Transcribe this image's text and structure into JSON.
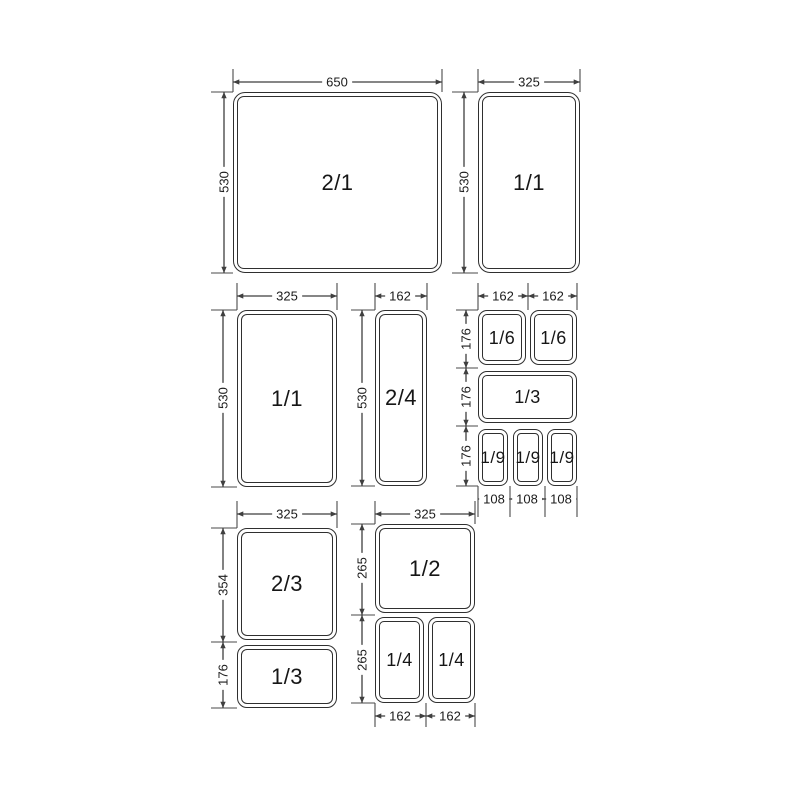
{
  "colors": {
    "background": "#ffffff",
    "line": "#3f3f3f",
    "box_border": "#2f2f2f",
    "text": "#1c1c1c"
  },
  "pans": {
    "gn_2_1": {
      "label": "2/1"
    },
    "gn_1_1_a": {
      "label": "1/1"
    },
    "gn_1_1_b": {
      "label": "1/1"
    },
    "gn_2_4": {
      "label": "2/4"
    },
    "gn_1_6_a": {
      "label": "1/6"
    },
    "gn_1_6_b": {
      "label": "1/6"
    },
    "gn_1_3_a": {
      "label": "1/3"
    },
    "gn_1_9_a": {
      "label": "1/9"
    },
    "gn_1_9_b": {
      "label": "1/9"
    },
    "gn_1_9_c": {
      "label": "1/9"
    },
    "gn_2_3": {
      "label": "2/3"
    },
    "gn_1_3_b": {
      "label": "1/3"
    },
    "gn_1_2": {
      "label": "1/2"
    },
    "gn_1_4_a": {
      "label": "1/4"
    },
    "gn_1_4_b": {
      "label": "1/4"
    }
  },
  "dimensions": {
    "top_left": {
      "width": "650",
      "height": "530"
    },
    "top_right": {
      "width": "325",
      "height": "530"
    },
    "mid_left": {
      "width": "325",
      "height": "530"
    },
    "mid_center": {
      "width": "162",
      "height": "530"
    },
    "mid_right": {
      "width_a": "162",
      "width_b": "162",
      "height_row1": "176",
      "height_row2": "176",
      "height_row3": "176",
      "bottom_a": "108",
      "bottom_b": "108",
      "bottom_c": "108"
    },
    "bottom_left": {
      "width": "325",
      "height_top": "354",
      "height_bottom": "176"
    },
    "bottom_center": {
      "width": "325",
      "height_top": "265",
      "height_bottom": "265",
      "bottom_a": "162",
      "bottom_b": "162"
    }
  }
}
